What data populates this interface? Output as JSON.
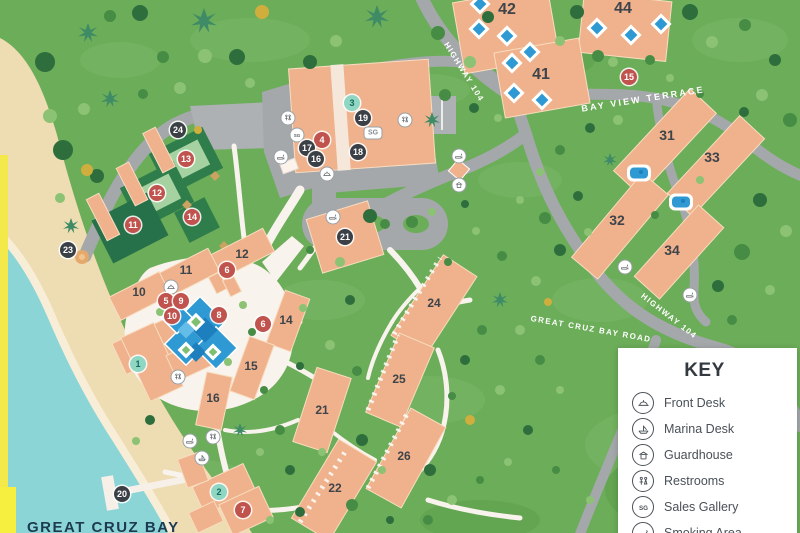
{
  "map": {
    "bay_label": "GREAT CRUZ BAY",
    "road_labels": [
      {
        "text": "HIGHWAY 104",
        "x": 464,
        "y": 72,
        "rot": 58,
        "wide": false
      },
      {
        "text": "BAY VIEW TERRACE",
        "x": 643,
        "y": 99,
        "rot": -9,
        "wide": true
      },
      {
        "text": "GREAT CRUZ BAY ROAD",
        "x": 591,
        "y": 329,
        "rot": 10,
        "wide": false
      },
      {
        "text": "HIGHWAY 104",
        "x": 669,
        "y": 316,
        "rot": 38,
        "wide": false
      }
    ],
    "building_labels": [
      {
        "t": "42",
        "x": 507,
        "y": 10,
        "s": "lg"
      },
      {
        "t": "44",
        "x": 623,
        "y": 9,
        "s": "lg"
      },
      {
        "t": "41",
        "x": 541,
        "y": 75,
        "s": "lg"
      },
      {
        "t": "31",
        "x": 667,
        "y": 135,
        "s": "md"
      },
      {
        "t": "33",
        "x": 712,
        "y": 157,
        "s": "md"
      },
      {
        "t": "32",
        "x": 617,
        "y": 220,
        "s": "md"
      },
      {
        "t": "34",
        "x": 672,
        "y": 250,
        "s": "md"
      },
      {
        "t": "12",
        "x": 242,
        "y": 254,
        "s": "sm"
      },
      {
        "t": "11",
        "x": 186,
        "y": 270,
        "s": "sm"
      },
      {
        "t": "10",
        "x": 139,
        "y": 292,
        "s": "sm"
      },
      {
        "t": "14",
        "x": 286,
        "y": 320,
        "s": "sm"
      },
      {
        "t": "15",
        "x": 251,
        "y": 366,
        "s": "sm"
      },
      {
        "t": "16",
        "x": 213,
        "y": 398,
        "s": "sm"
      },
      {
        "t": "21",
        "x": 322,
        "y": 410,
        "s": "sm"
      },
      {
        "t": "24",
        "x": 434,
        "y": 303,
        "s": "sm"
      },
      {
        "t": "25",
        "x": 399,
        "y": 379,
        "s": "sm"
      },
      {
        "t": "26",
        "x": 404,
        "y": 456,
        "s": "sm"
      },
      {
        "t": "22",
        "x": 335,
        "y": 488,
        "s": "sm"
      }
    ],
    "markers": [
      {
        "kind": "red",
        "n": "13",
        "x": 186,
        "y": 159
      },
      {
        "kind": "red",
        "n": "12",
        "x": 157,
        "y": 193
      },
      {
        "kind": "red",
        "n": "11",
        "x": 133,
        "y": 225
      },
      {
        "kind": "red",
        "n": "14",
        "x": 192,
        "y": 217
      },
      {
        "kind": "red",
        "n": "4",
        "x": 322,
        "y": 140
      },
      {
        "kind": "red",
        "n": "15",
        "x": 629,
        "y": 77
      },
      {
        "kind": "red",
        "n": "6",
        "x": 227,
        "y": 270
      },
      {
        "kind": "red",
        "n": "5",
        "x": 166,
        "y": 301
      },
      {
        "kind": "red",
        "n": "9",
        "x": 181,
        "y": 301
      },
      {
        "kind": "red",
        "n": "10",
        "x": 172,
        "y": 316
      },
      {
        "kind": "red",
        "n": "8",
        "x": 219,
        "y": 315
      },
      {
        "kind": "red",
        "n": "6",
        "x": 263,
        "y": 324
      },
      {
        "kind": "red",
        "n": "7",
        "x": 243,
        "y": 510
      },
      {
        "kind": "dark",
        "n": "24",
        "x": 178,
        "y": 130
      },
      {
        "kind": "dark",
        "n": "23",
        "x": 68,
        "y": 250
      },
      {
        "kind": "dark",
        "n": "19",
        "x": 363,
        "y": 118
      },
      {
        "kind": "dark",
        "n": "17",
        "x": 307,
        "y": 148
      },
      {
        "kind": "dark",
        "n": "16",
        "x": 316,
        "y": 159
      },
      {
        "kind": "dark",
        "n": "18",
        "x": 358,
        "y": 152
      },
      {
        "kind": "dark",
        "n": "21",
        "x": 345,
        "y": 237
      },
      {
        "kind": "dark",
        "n": "20",
        "x": 122,
        "y": 494
      },
      {
        "kind": "teal",
        "n": "3",
        "x": 352,
        "y": 103
      },
      {
        "kind": "teal",
        "n": "1",
        "x": 138,
        "y": 364
      },
      {
        "kind": "teal",
        "n": "2",
        "x": 219,
        "y": 492
      }
    ],
    "poi_icons": [
      {
        "type": "restrooms",
        "x": 288,
        "y": 118
      },
      {
        "type": "sales-gallery",
        "x": 297,
        "y": 135
      },
      {
        "type": "smoking-area",
        "x": 281,
        "y": 157
      },
      {
        "type": "front-desk",
        "x": 327,
        "y": 174
      },
      {
        "type": "restrooms",
        "x": 405,
        "y": 120
      },
      {
        "type": "sg-badge",
        "x": 373,
        "y": 133,
        "label": "SG"
      },
      {
        "type": "smoking-area",
        "x": 459,
        "y": 156
      },
      {
        "type": "guardhouse",
        "x": 459,
        "y": 185
      },
      {
        "type": "front-desk",
        "x": 171,
        "y": 287
      },
      {
        "type": "restrooms",
        "x": 178,
        "y": 377
      },
      {
        "type": "smoking-area",
        "x": 333,
        "y": 217
      },
      {
        "type": "restrooms",
        "x": 213,
        "y": 437
      },
      {
        "type": "smoking-area",
        "x": 190,
        "y": 441
      },
      {
        "type": "marina-desk",
        "x": 202,
        "y": 458
      },
      {
        "type": "smoking-area",
        "x": 625,
        "y": 267
      },
      {
        "type": "smoking-area",
        "x": 690,
        "y": 295
      }
    ],
    "colors": {
      "grass": "#6cad59",
      "sand": "#eedcb2",
      "water": "#8bd5d7",
      "road": "#a4a8aa",
      "path": "#f9f3ee",
      "building": "#efb28c",
      "court_green": "#2e7d4b",
      "pool_blue": "#2f99d3",
      "marker_red": "#c0534e",
      "marker_dark": "#3b4046",
      "marker_teal": "#8fd6c3",
      "edge_yellow": "#f3e94a"
    }
  },
  "key": {
    "title": "KEY",
    "items": [
      {
        "icon": "front-desk",
        "label": "Front Desk"
      },
      {
        "icon": "marina-desk",
        "label": "Marina Desk"
      },
      {
        "icon": "guardhouse",
        "label": "Guardhouse"
      },
      {
        "icon": "restrooms",
        "label": "Restrooms"
      },
      {
        "icon": "sales-gallery",
        "label": "Sales Gallery"
      },
      {
        "icon": "smoking-area",
        "label": "Smoking Area"
      }
    ]
  }
}
